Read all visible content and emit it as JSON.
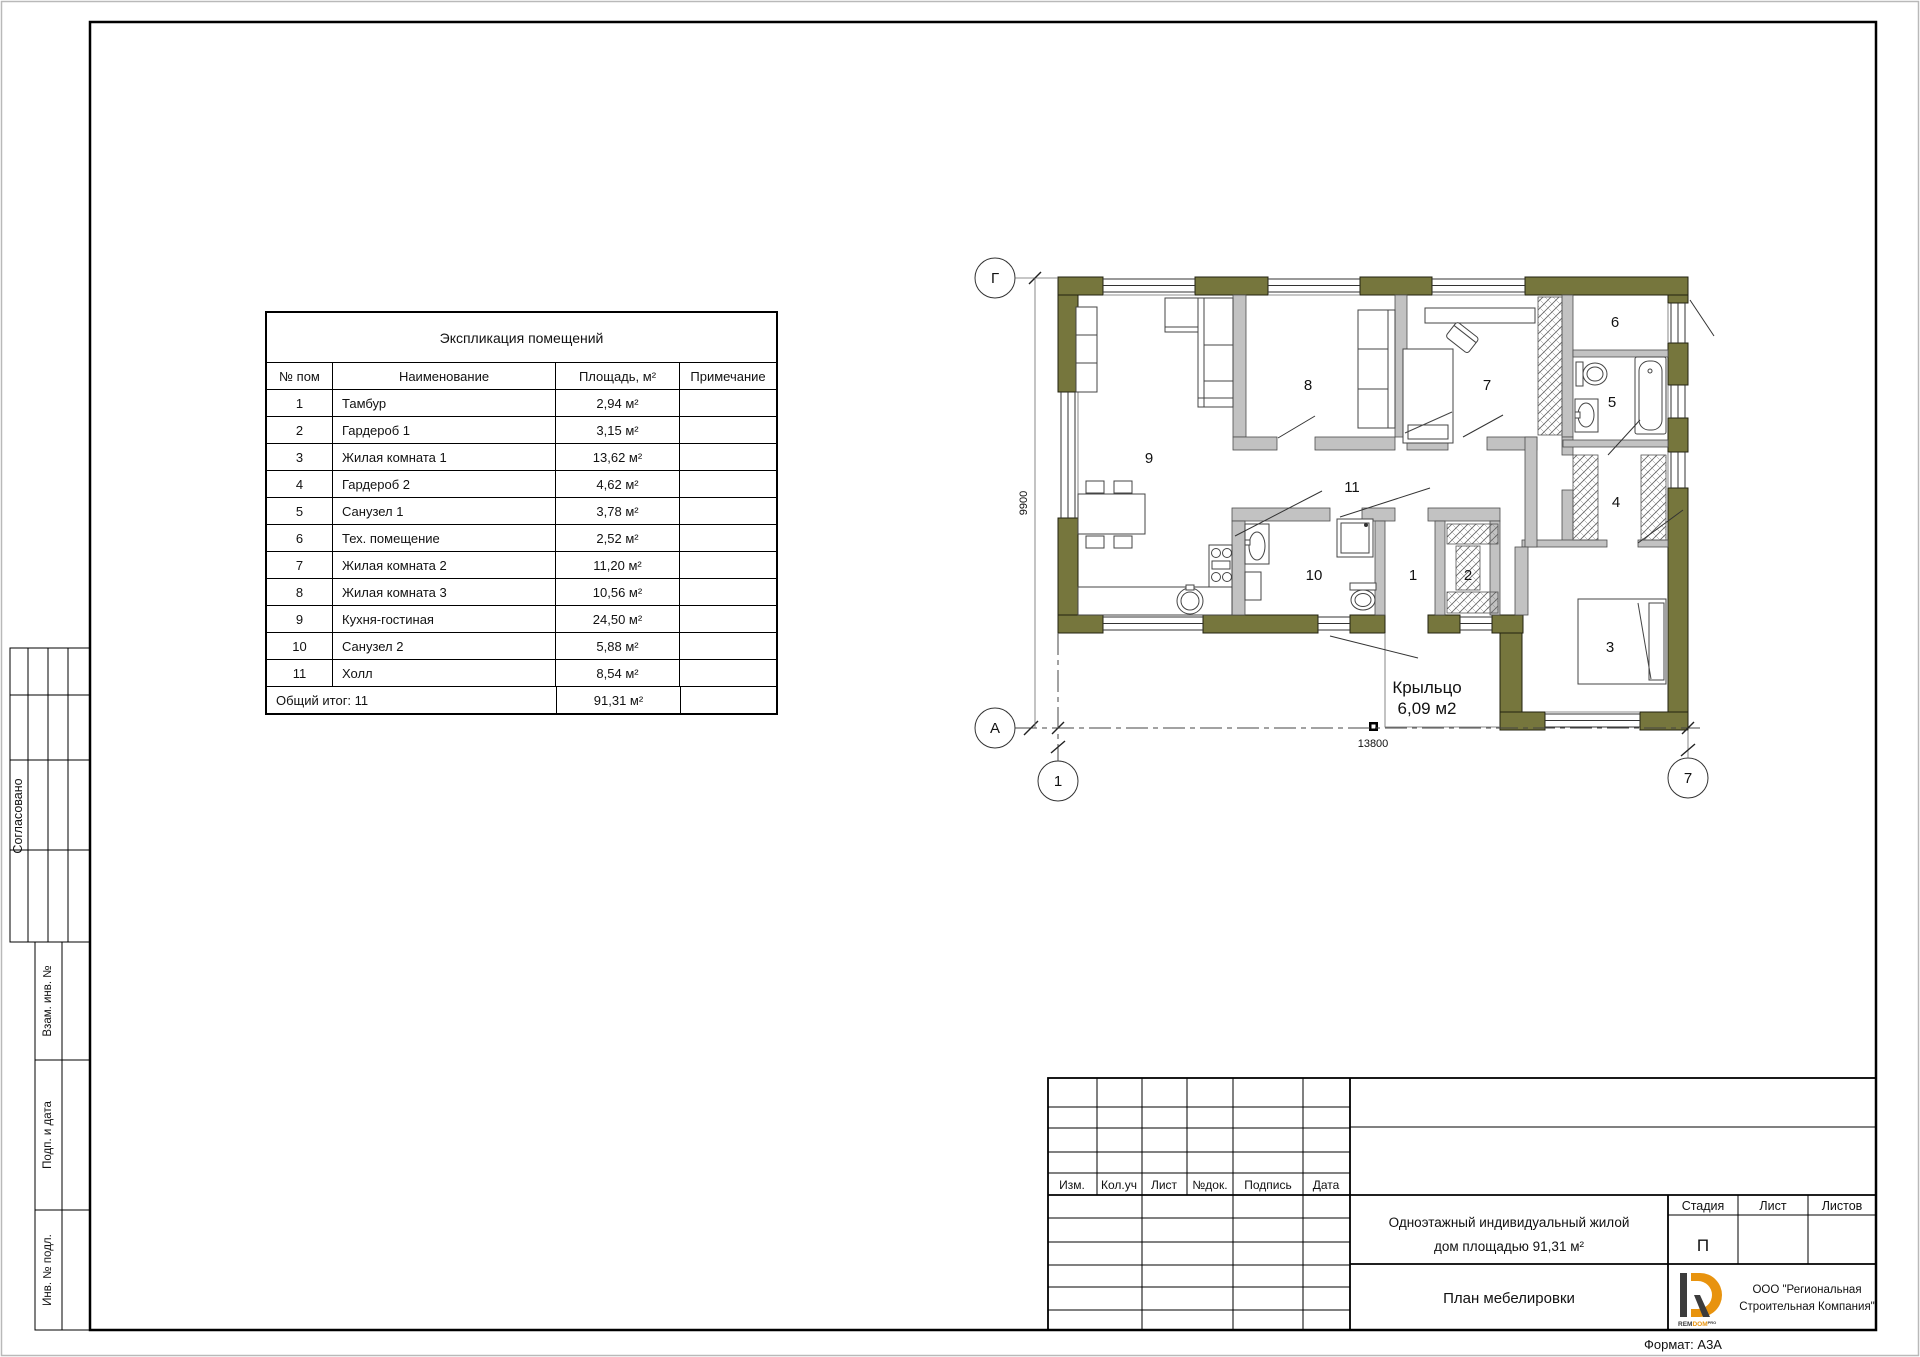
{
  "sheet": {
    "stamp_side": {
      "agreed": "Согласовано",
      "subst_inv_no": "Взам. инв. №",
      "sign_and_date": "Подп. и дата",
      "inv_no_orig": "Инв. № подл."
    },
    "format_note": "Формат: А3А"
  },
  "room_table": {
    "title": "Экспликация помещений",
    "headers": {
      "num": "№ пом",
      "name": "Наименование",
      "area": "Площадь, м²",
      "note": "Примечание"
    },
    "rows": [
      {
        "num": "1",
        "name": "Тамбур",
        "area": "2,94 м²",
        "note": ""
      },
      {
        "num": "2",
        "name": "Гардероб 1",
        "area": "3,15 м²",
        "note": ""
      },
      {
        "num": "3",
        "name": "Жилая комната 1",
        "area": "13,62 м²",
        "note": ""
      },
      {
        "num": "4",
        "name": "Гардероб 2",
        "area": "4,62 м²",
        "note": ""
      },
      {
        "num": "5",
        "name": "Санузел 1",
        "area": "3,78 м²",
        "note": ""
      },
      {
        "num": "6",
        "name": "Тех. помещение",
        "area": "2,52 м²",
        "note": ""
      },
      {
        "num": "7",
        "name": "Жилая комната 2",
        "area": "11,20 м²",
        "note": ""
      },
      {
        "num": "8",
        "name": "Жилая комната 3",
        "area": "10,56 м²",
        "note": ""
      },
      {
        "num": "9",
        "name": "Кухня-гостиная",
        "area": "24,50 м²",
        "note": ""
      },
      {
        "num": "10",
        "name": "Санузел 2",
        "area": "5,88 м²",
        "note": ""
      },
      {
        "num": "11",
        "name": "Холл",
        "area": "8,54 м²",
        "note": ""
      }
    ],
    "total_label": "Общий итог: 11",
    "total_area": "91,31 м²"
  },
  "plan": {
    "rooms": {
      "n1": "1",
      "n2": "2",
      "n3": "3",
      "n4": "4",
      "n5": "5",
      "n6": "6",
      "n7": "7",
      "n8": "8",
      "n9": "9",
      "n10": "10",
      "n11": "11"
    },
    "axes": {
      "top": "Г",
      "bottom": "А",
      "left": "1",
      "right": "7"
    },
    "dims": {
      "width": "13800",
      "height": "9900"
    },
    "porch_label_1": "Крыльцо",
    "porch_label_2": "6,09 м2"
  },
  "title_block": {
    "rev_headers": {
      "izm": "Изм.",
      "koluch": "Кол.уч",
      "list": "Лист",
      "ndok": "№док.",
      "podpis": "Подпись",
      "data": "Дата"
    },
    "project_line1": "Одноэтажный индивидуальный жилой",
    "project_line2": "дом площадью  91,31 м²",
    "stage_header": "Стадия",
    "sheet_header": "Лист",
    "sheets_header": "Листов",
    "stage_value": "П",
    "drawing_title": "План мебелировки",
    "company_line1": "ООО \"Региональная",
    "company_line2": "Строительная Компания\"",
    "logo_rem": "REM",
    "logo_dom": "DOM",
    "logo_sup": "PRO"
  },
  "colors": {
    "wall": "#76763D",
    "partition": "#C2C2C2",
    "logo_orange": "#E8930E",
    "logo_dark": "#3C3C3C"
  }
}
